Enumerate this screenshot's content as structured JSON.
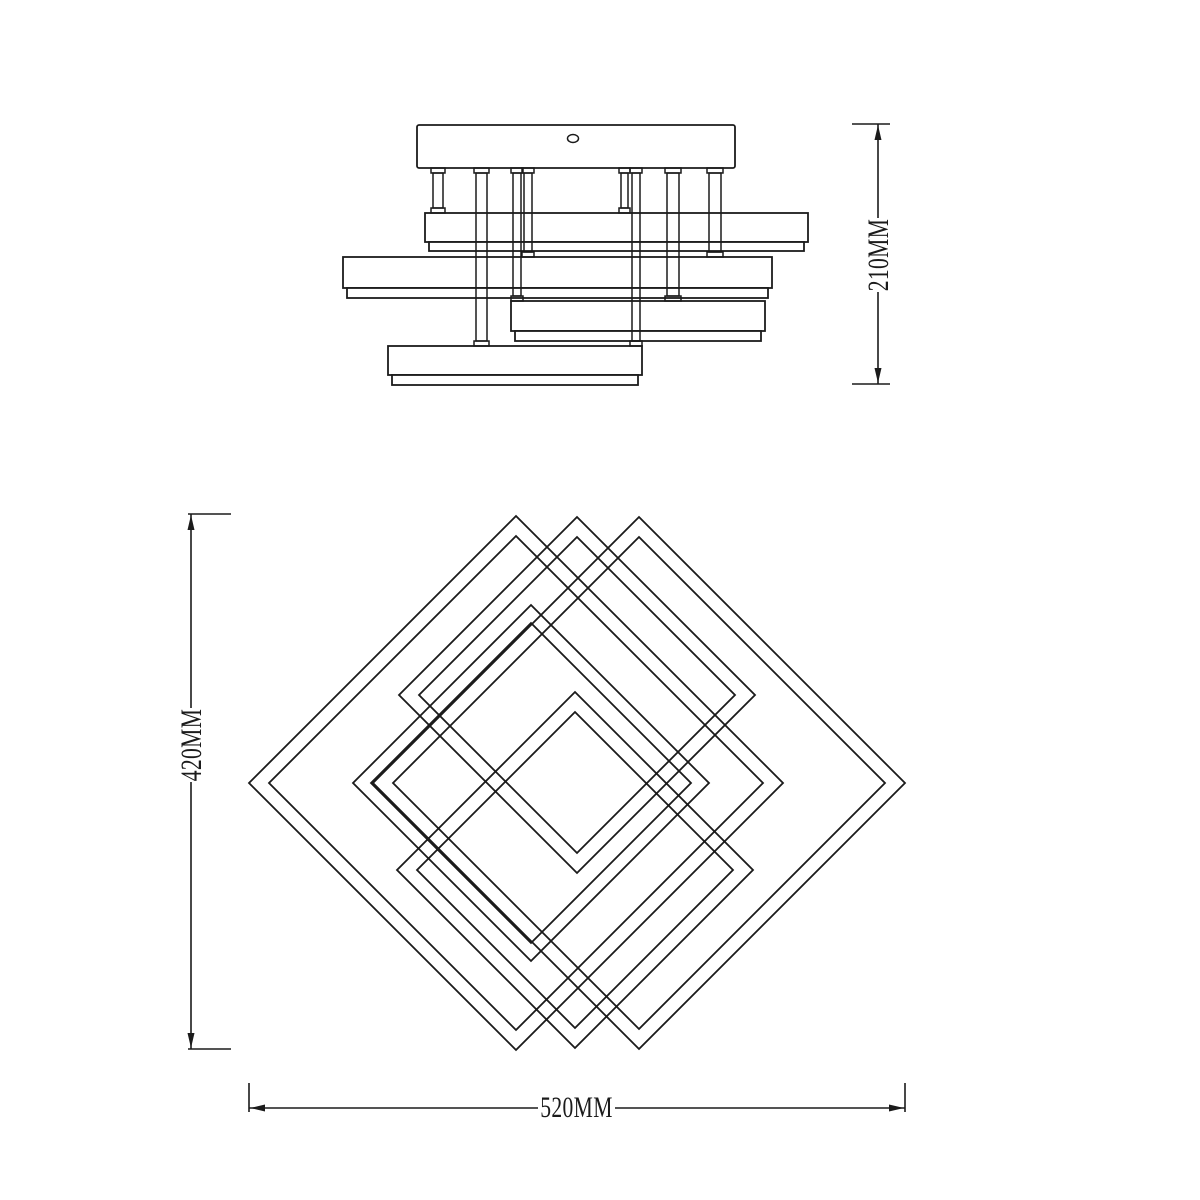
{
  "drawing": {
    "kind": "ceiling-lamp technical line drawing, front elevation above and plan view below",
    "line_color": "#1b1b1b",
    "background_color": "#ffffff",
    "dimensions": {
      "fixture_height": {
        "label": "210MM",
        "orientation": "vertical",
        "measures": "overall height of fixture in front elevation"
      },
      "plan_height": {
        "label": "420MM",
        "orientation": "vertical",
        "measures": "vertical diagonal of plan-view diamond pattern"
      },
      "plan_width": {
        "label": "520MM",
        "orientation": "horizontal",
        "measures": "overall width of plan-view diamond pattern"
      }
    },
    "elevation": {
      "parts": [
        "ceiling-canopy with oval slot",
        "eight support rods with flanges",
        "four stacked rectangular light bars with diffuser lips"
      ]
    },
    "plan": {
      "parts": [
        "five interlocking square frames rotated 45 degrees: two large, three medium"
      ]
    }
  }
}
